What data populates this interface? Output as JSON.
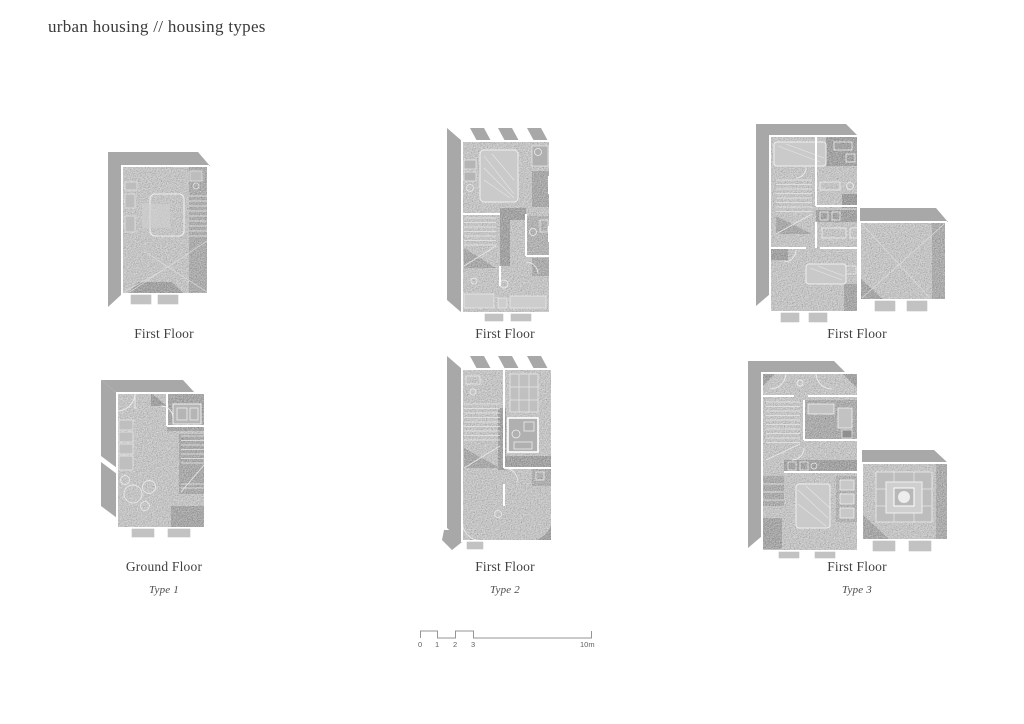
{
  "page": {
    "title": "urban housing // housing types",
    "background_color": "#ffffff"
  },
  "colors": {
    "shadow_gray": "#a8a8a8",
    "floor_gray": "#c6c6c6",
    "floor_dark_gray": "#9d9d9d",
    "wall_white": "#ffffff",
    "tab_gray": "#c2c2c2",
    "text_dark": "#3c3c3c",
    "scalebar_line": "#949494"
  },
  "plans": [
    {
      "floor_label": "First Floor"
    },
    {
      "floor_label": "First Floor"
    },
    {
      "floor_label": "First Floor"
    },
    {
      "floor_label": "Ground Floor",
      "type_label": "Type 1"
    },
    {
      "floor_label": "First Floor",
      "type_label": "Type 2"
    },
    {
      "floor_label": "First Floor",
      "type_label": "Type 3"
    }
  ],
  "scale_bar": {
    "ticks": [
      "0",
      "1",
      "2",
      "3",
      "10m"
    ]
  }
}
